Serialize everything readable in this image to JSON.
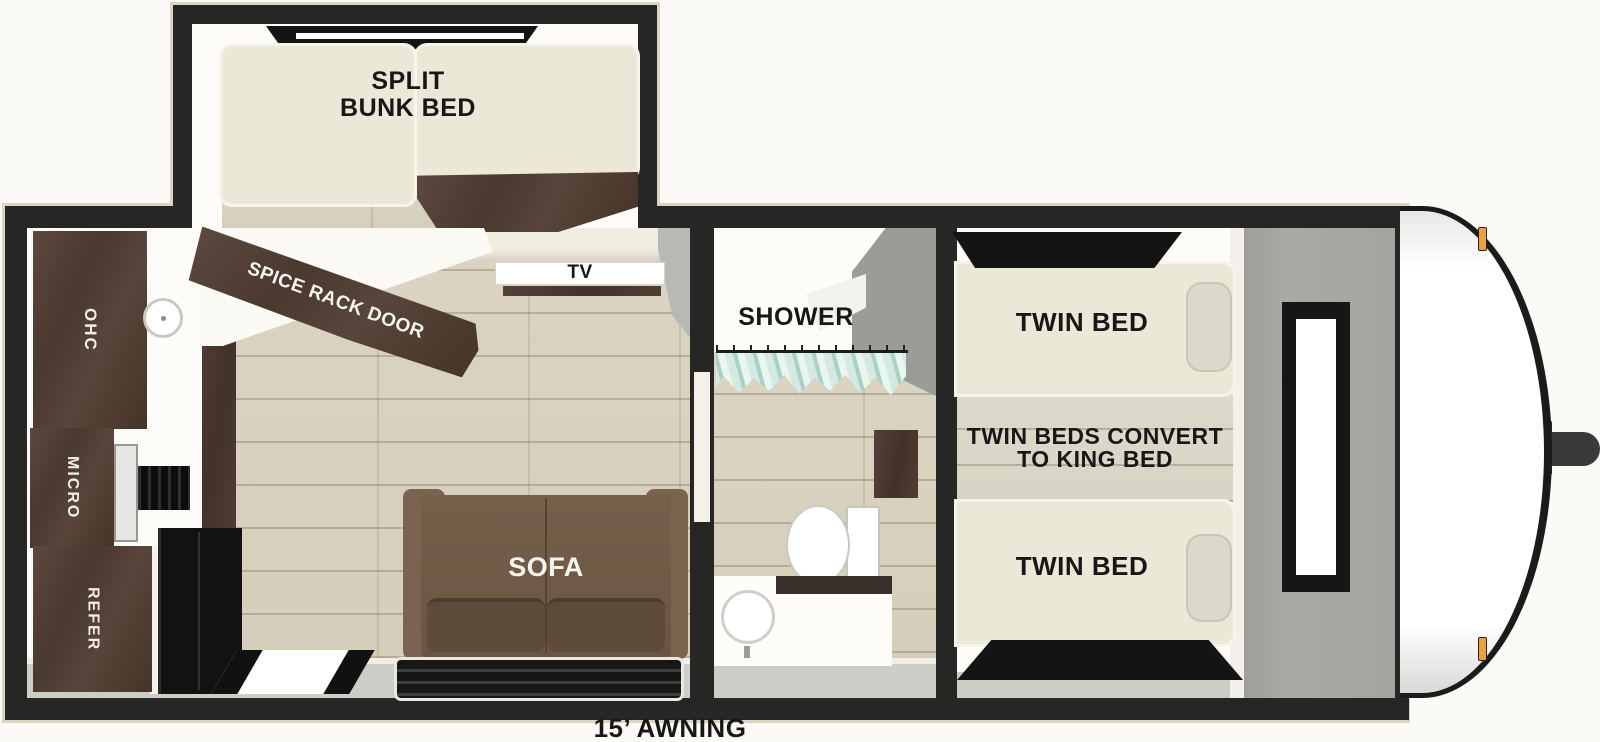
{
  "colors": {
    "wall": "#262624",
    "floor": "#d8d1bf",
    "mattress": "#ece8d7",
    "dark_wood": "#54413a",
    "sofa_brown": "#6f5a46",
    "gray_wall": "#a6a6a1",
    "curtain_teal": "#aed4c9",
    "marker_amber": "#e8a33d",
    "background": "#fbfaf6"
  },
  "floorplan": {
    "bunk_room": {
      "bed_label_line1": "SPLIT",
      "bed_label_line2": "BUNK BED",
      "door_label": "SPICE RACK DOOR"
    },
    "living_kitchen": {
      "tv": "TV",
      "overhead_cabinet": "OHC",
      "microwave": "MICRO",
      "refrigerator": "REFER",
      "sofa": "SOFA"
    },
    "bathroom": {
      "shower": "SHOWER"
    },
    "bedroom": {
      "front_twin": "TWIN BED",
      "rear_twin": "TWIN BED",
      "convert_line1": "TWIN BEDS CONVERT",
      "convert_line2": "TO KING BED"
    },
    "exterior": {
      "awning": "15’ AWNING"
    }
  }
}
